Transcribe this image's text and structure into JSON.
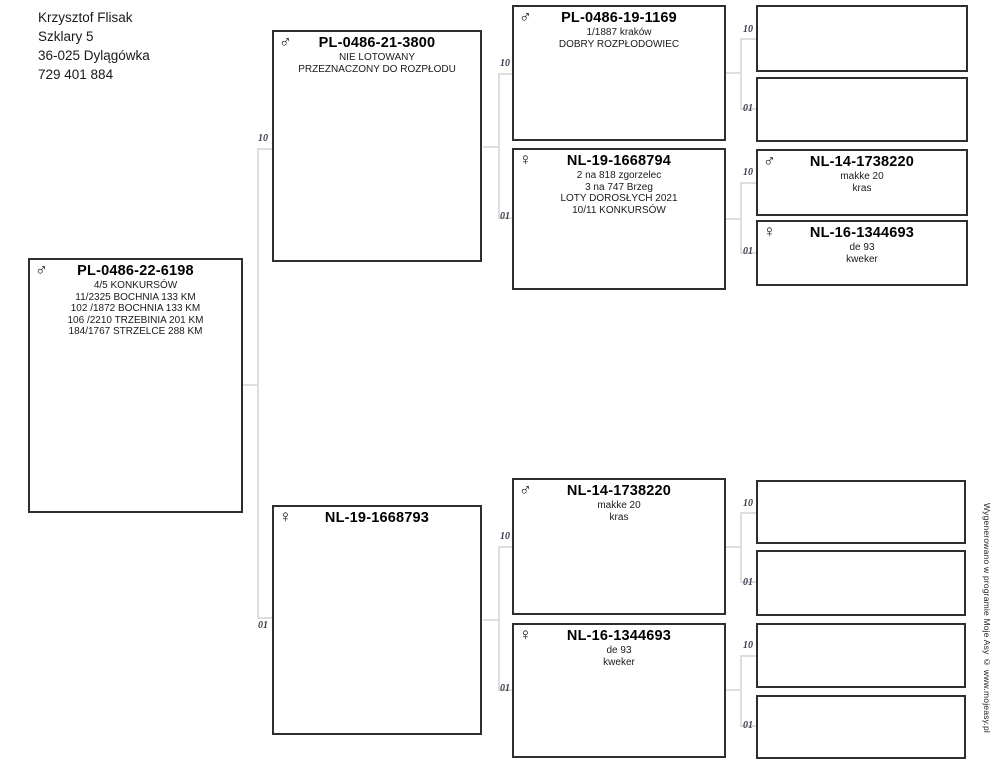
{
  "owner": {
    "name": "Krzysztof Flisak",
    "address_line1": "Szklary 5",
    "address_line2": "36-025 Dylągówka",
    "phone": "729 401 884"
  },
  "lineage_codes": {
    "sire": "10",
    "dam": "01"
  },
  "footer": {
    "credit": "Wygenerowano w programie Moje Asy © www.mojeasy.pl"
  },
  "pedigree": {
    "subject": {
      "sex": "male",
      "sex_symbol": "♂",
      "ring": "PL-0486-22-6198",
      "lines": [
        "4/5 KONKURSÓW",
        "11/2325 BOCHNIA 133 KM",
        "102 /1872 BOCHNIA 133 KM",
        "106 /2210 TRZEBINIA 201 KM",
        "184/1767 STRZELCE 288 KM"
      ]
    },
    "sire": {
      "sex": "male",
      "sex_symbol": "♂",
      "ring": "PL-0486-21-3800",
      "lines": [
        "NIE LOTOWANY",
        "PRZEZNACZONY DO ROZPŁODU"
      ]
    },
    "dam": {
      "sex": "female",
      "sex_symbol": "♀",
      "ring": "NL-19-1668793",
      "lines": []
    },
    "sire_sire": {
      "sex": "male",
      "sex_symbol": "♂",
      "ring": "PL-0486-19-1169",
      "lines": [
        "1/1887 kraków",
        "DOBRY ROZPŁODOWIEC"
      ]
    },
    "sire_dam": {
      "sex": "female",
      "sex_symbol": "♀",
      "ring": "NL-19-1668794",
      "lines": [
        "2 na 818 zgorzelec",
        "3 na 747 Brzeg",
        "LOTY DOROSŁYCH 2021",
        "10/11 KONKURSÓW"
      ]
    },
    "dam_sire": {
      "sex": "male",
      "sex_symbol": "♂",
      "ring": "NL-14-1738220",
      "lines": [
        "makke 20",
        "kras"
      ]
    },
    "dam_dam": {
      "sex": "female",
      "sex_symbol": "♀",
      "ring": "NL-16-1344693",
      "lines": [
        "de 93",
        "kweker"
      ]
    },
    "sire_dam_sire": {
      "sex": "male",
      "sex_symbol": "♂",
      "ring": "NL-14-1738220",
      "lines": [
        "makke 20",
        "kras"
      ]
    },
    "sire_dam_dam": {
      "sex": "female",
      "sex_symbol": "♀",
      "ring": "NL-16-1344693",
      "lines": [
        "de 93",
        "kweker"
      ]
    }
  }
}
